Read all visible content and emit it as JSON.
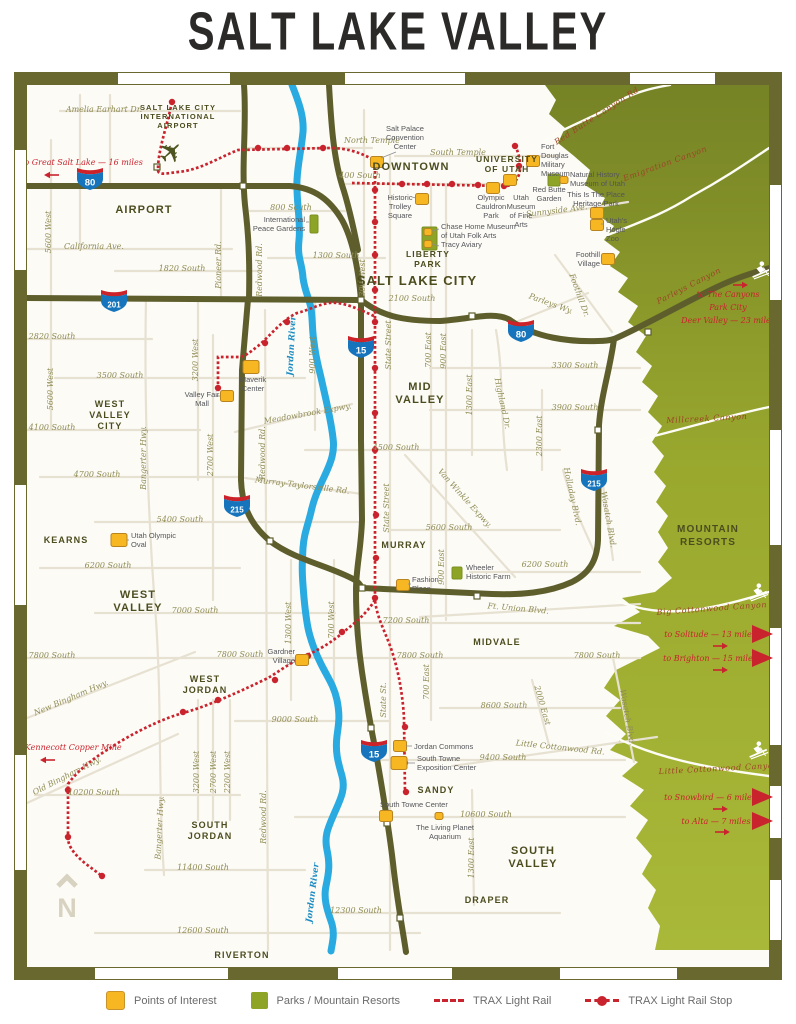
{
  "title": "SALT LAKE VALLEY",
  "colors": {
    "accent_red": "#c9242e",
    "road_olive": "#5e5e2d",
    "frame_olive": "#68682f",
    "park_green": "#8da427",
    "poi_yellow": "#f6b723",
    "river_blue": "#29aae1",
    "shield_blue": "#1574bc",
    "shield_red": "#cc2229",
    "label_olive": "#8f8c55",
    "city_olive": "#4c4d1f",
    "canyon_red": "#9c4527",
    "mtn_dark": "#768326",
    "mtn_light": "#a9b838"
  },
  "legend": {
    "items": [
      {
        "icon": "poi-swatch",
        "label": "Points of Interest"
      },
      {
        "icon": "park-swatch",
        "label": "Parks / Mountain Resorts"
      },
      {
        "icon": "trax-line-swatch",
        "label": "TRAX Light Rail"
      },
      {
        "icon": "trax-stop-swatch",
        "label": "TRAX Light Rail Stop"
      }
    ]
  },
  "map": {
    "city_labels": [
      [
        "SALT LAKE CITY",
        178,
        110,
        7.5,
        "#5a4a20"
      ],
      [
        "INTERNATIONAL",
        178,
        119,
        7.5,
        "#5a4a20"
      ],
      [
        "AIRPORT",
        178,
        128,
        7.5,
        "#5a4a20"
      ],
      [
        "AIRPORT",
        144,
        213,
        11
      ],
      [
        "DOWNTOWN",
        411,
        170,
        11
      ],
      [
        "UNIVERSITY",
        507,
        162,
        8.5
      ],
      [
        "OF UTAH",
        507,
        172,
        8.5
      ],
      [
        "SALT LAKE CITY",
        417,
        285,
        13
      ],
      [
        "LIBERTY",
        428,
        257,
        8.5
      ],
      [
        "PARK",
        428,
        267,
        8.5
      ],
      [
        "WEST",
        110,
        407,
        9
      ],
      [
        "VALLEY",
        110,
        418,
        9
      ],
      [
        "CITY",
        110,
        429,
        9
      ],
      [
        "MID",
        420,
        390,
        11
      ],
      [
        "VALLEY",
        420,
        403,
        11
      ],
      [
        "KEARNS",
        66,
        543,
        9
      ],
      [
        "WEST",
        138,
        598,
        11
      ],
      [
        "VALLEY",
        138,
        611,
        11
      ],
      [
        "MURRAY",
        404,
        548,
        9
      ],
      [
        "MIDVALE",
        497,
        645,
        9
      ],
      [
        "WEST",
        205,
        682,
        9
      ],
      [
        "JORDAN",
        205,
        693,
        9
      ],
      [
        "SOUTH",
        210,
        828,
        9
      ],
      [
        "JORDAN",
        210,
        839,
        9
      ],
      [
        "SANDY",
        436,
        793,
        9
      ],
      [
        "SOUTH",
        533,
        854,
        11
      ],
      [
        "VALLEY",
        533,
        867,
        11
      ],
      [
        "DRAPER",
        487,
        903,
        9
      ],
      [
        "RIVERTON",
        242,
        958,
        9
      ],
      [
        "MOUNTAIN",
        708,
        532,
        10
      ],
      [
        "RESORTS",
        708,
        545,
        10
      ]
    ],
    "street_labels": [
      [
        "Amelia Earhart Dr.",
        104,
        112
      ],
      [
        "North Temple",
        372,
        143
      ],
      [
        "South Temple",
        458,
        155
      ],
      [
        "400 South",
        360,
        178
      ],
      [
        "800 South",
        291,
        210
      ],
      [
        "1300 South",
        336,
        258
      ],
      [
        "California Ave.",
        94,
        249
      ],
      [
        "1820 South",
        182,
        271
      ],
      [
        "2100 South",
        412,
        301
      ],
      [
        "2820 South",
        52,
        339
      ],
      [
        "3300 South",
        575,
        368
      ],
      [
        "3500 South",
        120,
        378
      ],
      [
        "3900 South",
        575,
        410
      ],
      [
        "4100 South",
        52,
        430
      ],
      [
        "4500 South",
        396,
        450
      ],
      [
        "4700 South",
        97,
        477
      ],
      [
        "5400 South",
        180,
        522
      ],
      [
        "5600 South",
        449,
        530
      ],
      [
        "6200 South",
        108,
        568
      ],
      [
        "6200 South",
        545,
        567
      ],
      [
        "7000 South",
        195,
        613
      ],
      [
        "7200 South",
        406,
        623
      ],
      [
        "7800 South",
        52,
        658
      ],
      [
        "7800 South",
        240,
        657
      ],
      [
        "7800 South",
        420,
        658
      ],
      [
        "7800 South",
        597,
        658
      ],
      [
        "8600 South",
        504,
        708
      ],
      [
        "9000 South",
        295,
        722
      ],
      [
        "9400 South",
        503,
        760
      ],
      [
        "10200 South",
        94,
        795
      ],
      [
        "10600 South",
        486,
        817
      ],
      [
        "11400 South",
        203,
        870
      ],
      [
        "12300 South",
        356,
        913
      ],
      [
        "12600 South",
        203,
        933
      ],
      [
        "Sunnyside Ave.",
        557,
        213,
        -7
      ],
      [
        "Parleys Wy.",
        550,
        306,
        20
      ],
      [
        "Meadowbrook Expwy.",
        308,
        416,
        -10
      ],
      [
        "Murray-Taylorsville Rd.",
        302,
        488,
        7
      ],
      [
        "Ft. Union Blvd.",
        518,
        611,
        5
      ],
      [
        "Little Cottonwood Rd.",
        560,
        750,
        6
      ],
      [
        "New Bingham Hwy.",
        72,
        700,
        -23
      ],
      [
        "Old Bingham Hwy.",
        68,
        778,
        -27
      ],
      [
        "5600 West",
        51,
        232,
        -90
      ],
      [
        "5600 West",
        53,
        389,
        -90
      ],
      [
        "3200 West",
        198,
        360,
        -90
      ],
      [
        "3200 West",
        199,
        772,
        -90
      ],
      [
        "2700 West",
        213,
        455,
        -90
      ],
      [
        "2700 West",
        216,
        772,
        -90
      ],
      [
        "2200 West",
        230,
        772,
        -90
      ],
      [
        "900 West",
        315,
        355,
        -90
      ],
      [
        "300 West",
        365,
        278,
        -90
      ],
      [
        "1300 West",
        291,
        623,
        -90
      ],
      [
        "700 West",
        334,
        620,
        -90
      ],
      [
        "State Street",
        391,
        345,
        -90
      ],
      [
        "State Street",
        389,
        508,
        -90
      ],
      [
        "State St.",
        386,
        700,
        -90
      ],
      [
        "700 East",
        431,
        350,
        -90
      ],
      [
        "700 East",
        429,
        682,
        -90
      ],
      [
        "900 East",
        446,
        351,
        -90
      ],
      [
        "900 East",
        444,
        567,
        -90
      ],
      [
        "1300 East",
        472,
        395,
        -90
      ],
      [
        "1300 East",
        474,
        858,
        -90
      ],
      [
        "2300 East",
        542,
        436,
        -90
      ],
      [
        "Pioneer Rd.",
        221,
        265,
        -90
      ],
      [
        "Redwood Rd.",
        262,
        270,
        -90
      ],
      [
        "Redwood Rd.",
        265,
        453,
        -90
      ],
      [
        "Redwood Rd.",
        266,
        817,
        -90
      ],
      [
        "Bangerter Hwy.",
        146,
        458,
        -90
      ],
      [
        "Bangerter Hwy.",
        162,
        828,
        -87
      ],
      [
        "Foothill Dr.",
        577,
        296,
        70
      ],
      [
        "Highland Dr.",
        500,
        404,
        78
      ],
      [
        "Van Winkle Expwy.",
        463,
        500,
        48
      ],
      [
        "Holladay Blvd.",
        570,
        497,
        78
      ],
      [
        "Wasatch Blvd.",
        606,
        520,
        80
      ],
      [
        "Wasatch Blvd.",
        625,
        718,
        80
      ],
      [
        "2000 East",
        540,
        706,
        74
      ]
    ],
    "canyon_labels": [
      [
        "Red Butte Canyon Rd",
        598,
        118,
        -33
      ],
      [
        "Emigration Canyon",
        666,
        166,
        -20
      ],
      [
        "Parleys Canyon",
        690,
        288,
        -27
      ],
      [
        "Millcreek Canyon",
        707,
        421,
        -3
      ],
      [
        "Big Cottonwood Canyon",
        712,
        611,
        -4
      ],
      [
        "Little Cottonwood Canyon",
        719,
        771,
        -3
      ]
    ],
    "river_labels": [
      [
        "Jordan River",
        294,
        346,
        -87
      ],
      [
        "Jordan River",
        315,
        893,
        -83
      ]
    ],
    "pois": [
      {
        "n": "salt-palace-convention-center",
        "m": [
          377,
          162
        ],
        "lines": [
          "Salt Palace",
          "Convention",
          "Center"
        ],
        "l": [
          405,
          131
        ],
        "a": "middle",
        "leader": [
          396,
          152,
          381,
          158
        ]
      },
      {
        "n": "historic-trolley-square",
        "m": [
          422,
          199
        ],
        "lines": [
          "Historic",
          "Trolley",
          "Square"
        ],
        "l": [
          400,
          200
        ],
        "a": "middle",
        "leader": [
          412,
          197,
          416,
          198
        ]
      },
      {
        "n": "olympic-cauldron-park",
        "m": [
          493,
          188
        ],
        "lines": [
          "Olympic",
          "Cauldron",
          "Park"
        ],
        "l": [
          491,
          200
        ],
        "a": "middle"
      },
      {
        "n": "utah-museum-of-fine-arts",
        "m": [
          510,
          180
        ],
        "lines": [
          "Utah",
          "Museum",
          "of Fine",
          "Arts"
        ],
        "l": [
          521,
          200
        ],
        "a": "middle"
      },
      {
        "n": "fort-douglas-military-museum",
        "m": [
          533,
          161
        ],
        "lines": [
          "Fort",
          "Douglas",
          "Military",
          "Museum"
        ],
        "l": [
          541,
          149
        ],
        "a": "start"
      },
      {
        "n": "natural-history-museum-of-utah",
        "m": [
          564,
          180
        ],
        "size": "s",
        "lines": [
          "Natural History",
          "Museum of Utah"
        ],
        "l": [
          570,
          177
        ],
        "a": "start"
      },
      {
        "n": "red-butte-garden",
        "lines": [
          "Red Butte",
          "Garden"
        ],
        "l": [
          549,
          192
        ],
        "a": "middle"
      },
      {
        "n": "this-is-the-place-heritage-park",
        "m": [
          597,
          213
        ],
        "lines": [
          "This Is The Place",
          "Heritage Park"
        ],
        "l": [
          596,
          197
        ],
        "a": "middle"
      },
      {
        "n": "utahs-hogle-zoo",
        "m": [
          597,
          225
        ],
        "lines": [
          "Utah's",
          "Hogle",
          "Zoo"
        ],
        "l": [
          606,
          223
        ],
        "a": "start",
        "leader": [
          601,
          224,
          604,
          224
        ]
      },
      {
        "n": "foothill-village",
        "m": [
          608,
          259
        ],
        "lines": [
          "Foothill",
          "Village"
        ],
        "l": [
          600,
          257
        ],
        "a": "end"
      },
      {
        "n": "chase-home-museum-of-utah-folk-arts",
        "m": [
          428,
          232
        ],
        "size": "s",
        "lines": [
          "Chase Home Museum",
          "of Utah Folk Arts"
        ],
        "l": [
          441,
          229
        ],
        "a": "start",
        "leader": [
          432,
          231,
          439,
          229
        ]
      },
      {
        "n": "tracy-aviary",
        "m": [
          428,
          244
        ],
        "size": "s",
        "lines": [
          "Tracy Aviary"
        ],
        "l": [
          441,
          247
        ],
        "a": "start",
        "leader": [
          432,
          244,
          439,
          246
        ]
      },
      {
        "n": "international-peace-gardens",
        "lines": [
          "International",
          "Peace Gardens"
        ],
        "l": [
          305,
          222
        ],
        "a": "end",
        "leader": [
          306,
          222,
          309,
          222
        ]
      },
      {
        "n": "maverik-center",
        "m": [
          251,
          367
        ],
        "size": "b",
        "lines": [
          "Maverik",
          "Center"
        ],
        "l": [
          253,
          382
        ],
        "a": "middle"
      },
      {
        "n": "valley-fair-mall",
        "m": [
          227,
          396
        ],
        "lines": [
          "Valley Fair",
          "Mall"
        ],
        "l": [
          202,
          397
        ],
        "a": "middle",
        "leader": [
          216,
          396,
          220,
          396
        ]
      },
      {
        "n": "utah-olympic-oval",
        "m": [
          119,
          540
        ],
        "size": "b",
        "lines": [
          "Utah Olympic",
          "Oval"
        ],
        "l": [
          131,
          538
        ],
        "a": "start",
        "leader": [
          127,
          540,
          129,
          540
        ]
      },
      {
        "n": "wheeler-historic-farm",
        "lines": [
          "Wheeler",
          "Historic Farm"
        ],
        "l": [
          466,
          570
        ],
        "a": "start"
      },
      {
        "n": "fashion-place",
        "m": [
          403,
          585
        ],
        "lines": [
          "Fashion",
          "Place"
        ],
        "l": [
          412,
          582
        ],
        "a": "start",
        "leader": [
          408,
          584,
          411,
          584
        ]
      },
      {
        "n": "gardner-village",
        "m": [
          302,
          660
        ],
        "lines": [
          "Gardner",
          "Village"
        ],
        "l": [
          295,
          654
        ],
        "a": "end"
      },
      {
        "n": "jordan-commons",
        "m": [
          400,
          746
        ],
        "lines": [
          "Jordan Commons"
        ],
        "l": [
          414,
          749
        ],
        "a": "start",
        "leader": [
          406,
          746,
          412,
          746
        ]
      },
      {
        "n": "south-towne-exposition-center",
        "m": [
          399,
          763
        ],
        "size": "b",
        "lines": [
          "South Towne",
          "Exposition Center"
        ],
        "l": [
          417,
          761
        ],
        "a": "start",
        "leader": [
          407,
          763,
          415,
          763
        ]
      },
      {
        "n": "south-towne-center",
        "m": [
          386,
          816
        ],
        "lines": [
          "South Towne Center"
        ],
        "l": [
          380,
          807
        ],
        "a": "start"
      },
      {
        "n": "the-living-planet-aquarium",
        "m": [
          439,
          816
        ],
        "size": "s",
        "lines": [
          "The Living Planet",
          "Aquarium"
        ],
        "l": [
          445,
          830
        ],
        "a": "middle"
      }
    ],
    "parks": [
      {
        "n": "liberty-park",
        "r": [
          422,
          227,
          15,
          23
        ]
      },
      {
        "n": "international-peace-gardens",
        "r": [
          310,
          215,
          8,
          18
        ]
      },
      {
        "n": "red-butte-garden",
        "r": [
          548,
          174,
          12,
          12
        ]
      },
      {
        "n": "wheeler-historic-farm",
        "r": [
          452,
          567,
          10,
          12
        ]
      }
    ],
    "shields": [
      {
        "num": "80",
        "x": 90,
        "y": 176
      },
      {
        "num": "201",
        "x": 114,
        "y": 298
      },
      {
        "num": "15",
        "x": 361,
        "y": 344
      },
      {
        "num": "80",
        "x": 521,
        "y": 328
      },
      {
        "num": "215",
        "x": 237,
        "y": 503
      },
      {
        "num": "215",
        "x": 594,
        "y": 477
      },
      {
        "num": "15",
        "x": 374,
        "y": 748
      }
    ],
    "destinations": [
      {
        "n": "great-salt-lake",
        "lines": [
          "to Great Salt Lake — 16 miles"
        ],
        "x": 82,
        "y": 165,
        "arrow": {
          "d": "l",
          "x": 44,
          "y": 175
        }
      },
      {
        "n": "kennecott-copper-mine",
        "lines": [
          "to Kennecott Copper Mine"
        ],
        "x": 68,
        "y": 750,
        "arrow": {
          "d": "l",
          "x": 40,
          "y": 760
        }
      },
      {
        "n": "park-city-deer-valley",
        "lines": [
          "to The Canyons",
          "Park City",
          "Deer Valley — 23 miles"
        ],
        "x": 728,
        "y": 297,
        "arrow": {
          "d": "r",
          "x": 748,
          "y": 285
        }
      },
      {
        "n": "solitude",
        "lines": [
          "to Solitude — 13 miles"
        ],
        "x": 710,
        "y": 637,
        "arrow": {
          "d": "r",
          "x": 728,
          "y": 646
        },
        "tri": [
          752,
          634
        ]
      },
      {
        "n": "brighton",
        "lines": [
          "to Brighton — 15 miles"
        ],
        "x": 710,
        "y": 661,
        "arrow": {
          "d": "r",
          "x": 728,
          "y": 670
        },
        "tri": [
          752,
          658
        ]
      },
      {
        "n": "snowbird",
        "lines": [
          "to Snowbird — 6 miles"
        ],
        "x": 710,
        "y": 800,
        "arrow": {
          "d": "r",
          "x": 728,
          "y": 809
        },
        "tri": [
          752,
          797
        ]
      },
      {
        "n": "alta",
        "lines": [
          "to Alta — 7 miles"
        ],
        "x": 716,
        "y": 824,
        "arrow": {
          "d": "r",
          "x": 730,
          "y": 832
        },
        "tri": [
          752,
          821
        ]
      }
    ],
    "icons": [
      {
        "t": "plane",
        "x": 178,
        "y": 150
      },
      {
        "t": "skier",
        "x": 760,
        "y": 272
      },
      {
        "t": "skier",
        "x": 757,
        "y": 594
      },
      {
        "t": "skier",
        "x": 757,
        "y": 752
      },
      {
        "t": "north",
        "x": 67,
        "y": 885
      }
    ]
  }
}
